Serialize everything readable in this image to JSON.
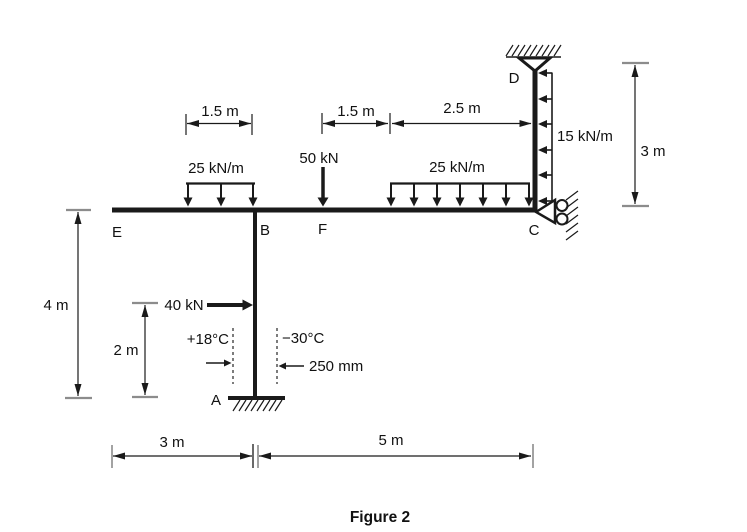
{
  "caption": "Figure 2",
  "colors": {
    "ink": "#1a1a1a",
    "tick_gray": "#8c8c8c",
    "background": "#ffffff"
  },
  "nodes": {
    "a": "A",
    "b": "B",
    "c": "C",
    "d": "D",
    "e": "E",
    "f": "F"
  },
  "loads": {
    "udl_beam_left": "25 kN/m",
    "udl_beam_right": "25 kN/m",
    "udl_column_cd": "15 kN/m",
    "point_load_f": "50 kN",
    "point_load_column": "40 kN"
  },
  "dimensions": {
    "span_udl_left": "1.5 m",
    "span_f_to_udl": "1.5 m",
    "span_udl_to_c": "2.5 m",
    "height_cd": "3 m",
    "height_frame": "4 m",
    "height_load_40": "2 m",
    "span_e_to_b": "3 m",
    "span_b_to_c": "5 m",
    "member_width": "250 mm"
  },
  "temperatures": {
    "left_face": "+18°C",
    "right_face": "−30°C"
  }
}
